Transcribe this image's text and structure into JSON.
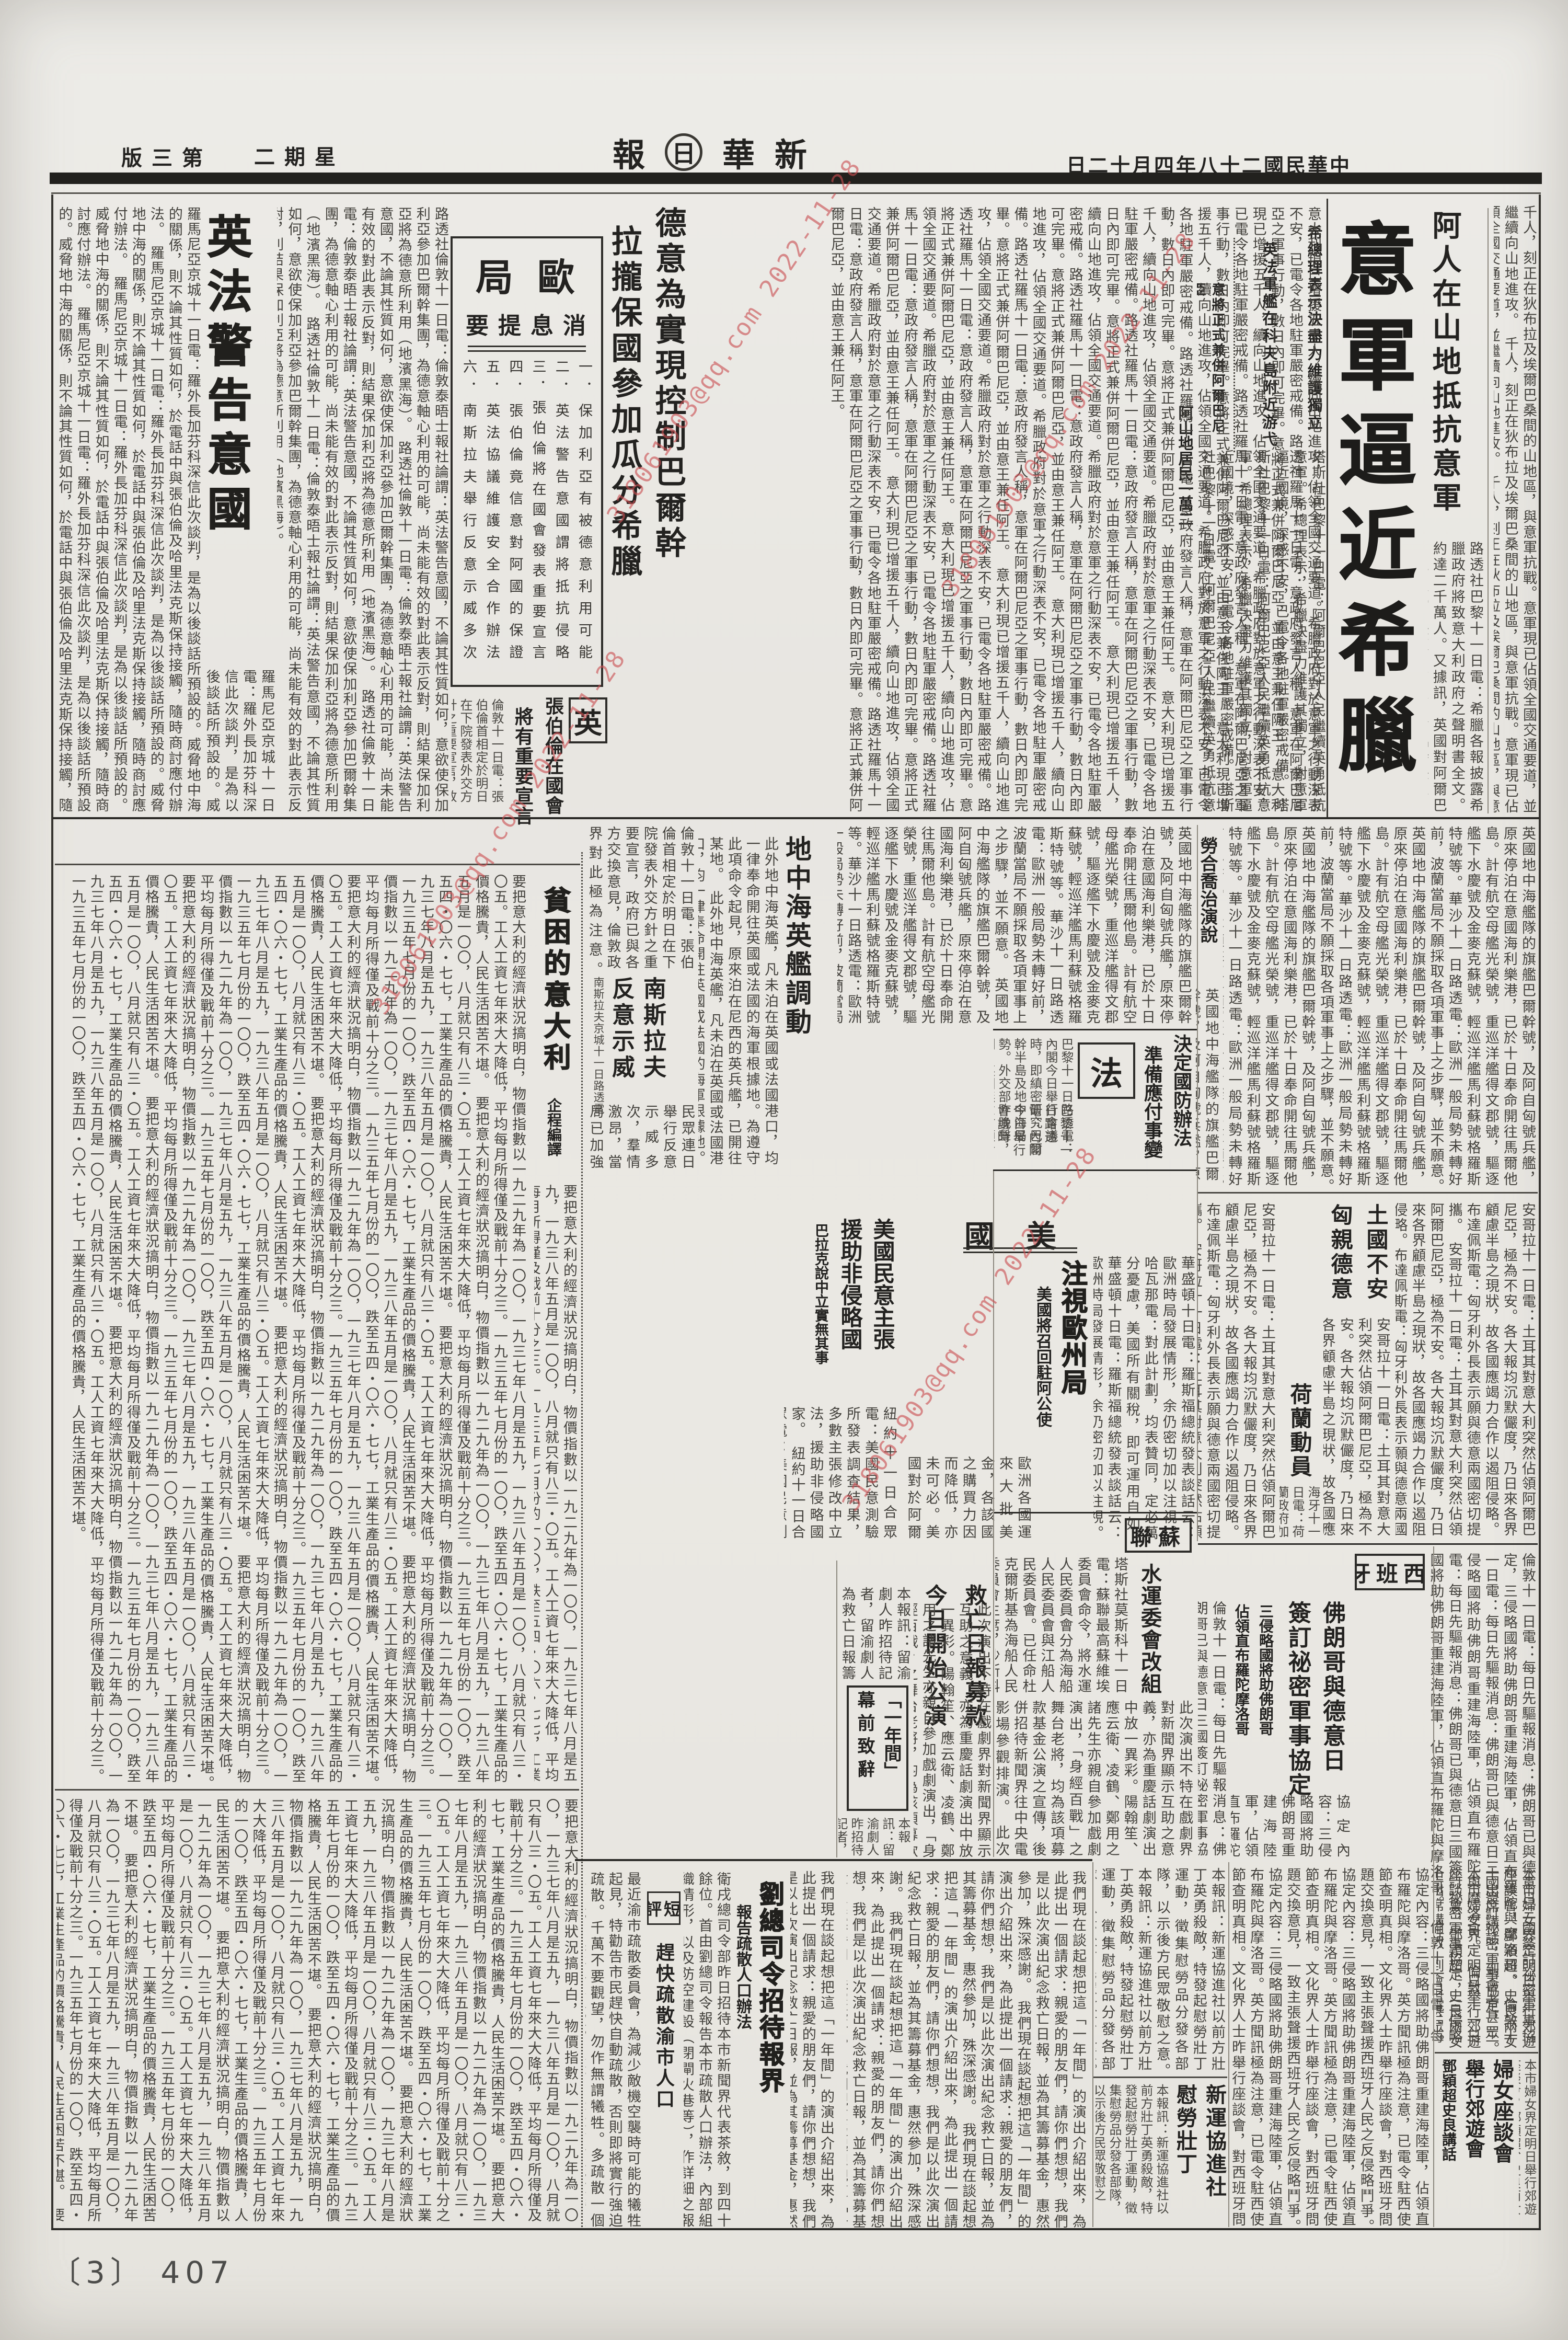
{
  "page": {
    "number_label": "〔3〕 407"
  },
  "watermark": {
    "text": "318061903@qq.com 2022-11-28"
  },
  "header": {
    "date": "中華民國二十八年四月十二日",
    "date_display": "日二十月四年八十二國民華中",
    "masthead": "新華日報",
    "masthead_chars": [
      "報",
      "日",
      "華",
      "新"
    ],
    "weekday": "星期二",
    "weekday_display": "二期星",
    "edition": "第三版",
    "edition_display": "版三第"
  },
  "main_story": {
    "kicker": "阿人在山地抵抗意軍",
    "headline": "意軍逼近希臘",
    "subhead1": "希總理表示決盡力維護獨立",
    "subhead2": "英法軍艦在科夫島附近游弋",
    "subhead3": "意將正式兼併阿爾巴尼亞",
    "inline_subhead": "阿山地居民一萬二",
    "col_right": "千人，刻正在狄布拉及埃爾巴桑間的山地區，與意軍抗戰。意軍現已佔領全國交通要道，並繼續向山地進攻。",
    "lead": "塔斯社巴黎十一日電：阿爾巴尼亞人民繼續英勇抵抗意軍。希總理表示，希臘決盡力維護其獨立，對意軍逼近國境，深感不安，已電令各地駐軍嚴密戒備。",
    "body": "路透社巴黎十一日電：希臘各報披露希臘政府將致意大利政府之聲明書全文。約達二千萬人。又據訊，英國對阿爾巴尼亞問題的決策，有賴國會臨時決定的可能。又各方對於科夫島的風雲，意大利仍密切注意，英國當不致採取較強硬之外交動作。（中央社）"
  },
  "europe_digest": {
    "title": "歐局",
    "title_display": "局歐",
    "subtitle": "消息提要",
    "subtitle_display": "要提息消",
    "items": [
      "一．保加利亞有被德意利用可能",
      "二．英法警告意國謂將抵抗侵略",
      "三．張伯倫將在國會發表重要宣言",
      "四．張伯倫竟信意對阿國的保證",
      "五．英法協議維護安全合作辦法",
      "六．南斯拉夫舉行反意示威多次"
    ]
  },
  "germany_italy": {
    "headline_l1": "德意為實現控制巴爾幹",
    "headline_l2": "拉攏保國參加瓜分希臘"
  },
  "uk_section": {
    "label": "英",
    "headline_l1": "張伯倫在國會",
    "headline_l2": "將有重要宣言",
    "body": "倫敦十一日電：張伯倫首相定於明日在下院發表外交方針之重要宣言，政府已與各方交換意見，倫敦政界對此極為注意。"
  },
  "warning_story": {
    "headline": "英法警告意國",
    "body1": "路透社倫敦十一日電：倫敦泰晤士報社論謂：英法警告意國，不論其性質如何，意欲使保加利亞參加巴爾幹集團，為德意軸心利用的可能，尚未能有效的對此表示反對，則結果保加利亞將為德意所利用（地濱黑海）。",
    "body2": "羅馬尼亞京城十一日電：羅外長加芬科深信此次談判，是為以後談話所預設的。威脅地中海的關係，則不論其性質如何，於電話中與張伯倫及哈里法克斯保持接觸，隨時商討應付辦法。"
  },
  "mediterranean": {
    "headline": "地中海英艦調動",
    "body": "此外地中海英艦，凡未泊在英國或法國港口，均一律奉命開往英國或法國的海軍根據地。為遵守此項命令起見，原來泊在尼西的英兵艦，已開往某地。"
  },
  "lloyd_george": {
    "headline": "勞合喬治演說"
  },
  "yugoslavia": {
    "headline_l1": "南斯拉夫",
    "headline_l2": "反意示威",
    "dateline": "南斯拉夫京城十一日路透電",
    "body": "民眾連日舉行反意示威多次，羣情激昂，當局已加強戒備，並成立物物交換協定。"
  },
  "poor_italy": {
    "headline": "貧困的意大利",
    "credit": "企程編譯",
    "body": "要把意大利的經濟狀況搞明白，物價指數以一九二九年為一〇〇，一九三七年八月是五九，一九三八年五月是一〇〇，八月就只有八三・〇五。工人工資七年來大大降低，平均每月所得僅及戰前十分之三。一九三五年七月份的一〇〇，跌至五四・〇六・七七，工業生產品的價格騰貴，人民生活困苦不堪。"
  },
  "france_section": {
    "label": "法",
    "headline_l1": "決定國防辦法",
    "headline_l2": "準備應付事變",
    "body": "巴黎十一日路透電：內閣今日舉行會議時，即縝密研究巴爾幹半島及地中海局勢。外交部昨晚聲明，英國無意佔領希臘的科夫島。但英法當就維護安全的合作辦法，舉行協議。"
  },
  "us_section": {
    "label": "美國",
    "label_display": "國美",
    "headline": "注視歐州局勢",
    "subhead": "美國將召回駐阿公使",
    "body": "華盛頓十日電：羅斯福總統發表談話云：歐洲時局發展情形，余仍密切加以注視。哈瓦那電：對此計劃，均表贊同，定必萬分憂慮，美國所有關稅，即可運用自如。"
  },
  "us_opinion": {
    "headline_l1": "美國民意主張",
    "headline_l2": "援助非侵略國",
    "subhead": "巴拉克說中立實無其事",
    "body": "紐約十一日合眾電：美國民意測驗所發表調查結果，多數主張修改中立法，援助非侵略國家。"
  },
  "turkey": {
    "headline": "土國不安"
  },
  "hungary": {
    "headline": "匈親德意"
  },
  "holland": {
    "headline": "荷蘭動員",
    "body": "海牙十一日電：荷蘭政府加強戒備，已下令動員若干部隊，並嚴密注視國際形勢之演變。"
  },
  "ussr_section": {
    "label": "蘇聯",
    "label_display": "聯蘇",
    "headline": "水運委會改組",
    "body": "塔斯社莫斯科十一日電：蘇聯最高蘇維埃委員會命令，將水運人民委員會分為海船人民委員會與江船人民委員會。已任命杜克爾斯基為海船人民委員會主席，沙斯科夫為江船人民委員會主席。"
  },
  "spain_section": {
    "label": "西班牙",
    "label_display": "牙班西",
    "headline_l1": "佛朗哥與德意日",
    "headline_l2": "簽訂祕密軍事協定",
    "subhead_l1": "三侵略國將助佛朗哥",
    "subhead_l2": "佔領直布羅陀摩洛哥",
    "body": "倫敦十一日電：每日先驅報消息：佛朗哥已與德意日三國簽訂祕密軍事協定，三侵略國將助佛朗哥重建海陸軍，佔領直布羅陀與摩洛哥。"
  },
  "jiuwang": {
    "headline_l1": "救亡日報募款",
    "headline_l2": "今日開始公演",
    "body": "本報訊：留渝劇人昨招待記者，留渝劇人為救亡日報籌募基金演出之四幕劇「一年間」，今日開始公演。"
  },
  "one_year": {
    "headline_l1": "「一年間」",
    "headline_l2": "幕前致辭",
    "body": "此次演出不特在戲劇界對新聞界顯示互助之意義，亦為重慶話劇演出中放一異彩。陽翰笙、應云衛、凌鶴、鄭用之諸先生亦親自參加戲劇演出，「身經百戰」之舞台老將，均為該項募款基金公演之宣傳，後併招待新聞界往中央電影場參觀排演。"
  },
  "liu_commander": {
    "headline": "劉總司令招待報界",
    "subhead": "報告疏散人口辦法",
    "body": "衛戌總司令部昨日招待本市新聞界代表茶敘，到四十餘位。首由劉總司令報告本市疏散人口辦法，內部組織情形，以及防空建設（閉閘火巷等），作詳細之報告後，新聞界代表等亦相繼發言，對於疏散工作之推進交換意見。"
  },
  "short_comment": {
    "label": "短評",
    "label_display": "評短",
    "headline": "趕快疏散渝市人口",
    "body": "最近渝市疏散委員會，為減少敵機空襲時可能的犧牲起見，特勸告市民趕快自動疏散，否則即將實行強迫疏散。千萬不要觀望，勿作無謂犧牲。多疏散一個人，就多保存一分抗戰力量。"
  },
  "xinyun": {
    "headline_l1": "新運協進社",
    "headline_l2": "慰勞壯丁",
    "body": "本報訊：新運協進社以前方壯丁英勇殺敵，特發起慰勞壯丁運動，徵集慰勞品分發各部隊，以示後方民眾敬慰之意。"
  },
  "women": {
    "headline_l1": "婦女座談會",
    "headline_l2": "舉行郊遊會",
    "subhead": "鄧穎超史良講話",
    "body": "本市婦女界定明日舉行郊遊座談會，鄧穎超、史良兩女士出席講話，到會者甚眾。"
  },
  "fillers": {
    "main_cont": "意大利現已增援五千人，續向山地進攻，佔領全國交通要道。希臘政府對於意軍之行動深表不安，已電令各地駐軍嚴密戒備。路透社羅馬十一日電：意政府發言人稱，意軍在阿爾巴尼亞之軍事行動，數日內即可完畢。意將正式兼併阿爾巴尼亞，並由意王兼任阿王。",
    "band2_right": "英國地中海艦隊的旗艦巴爾幹號，及阿自匈號兵艦，原來停泊在意國海利樂港，已於十日奉命開往馬爾他島。計有航空母艦光榮號，重巡洋艦得文郡號，驅逐艦下水慶號及金麥克蘇號，輕巡洋艦馬利蘇號格羅斯特號等。華沙十一日路透電：歐洲一般局勢未轉好前，波蘭當局不願採取各項軍事上之步驟，並不願意。",
    "us_misc": "歐洲各國運來大批美金，各該國之購買力因而降低，亦未可必。美國對於阿爾巴尼亞一事，將靜觀其後略。對此計劃，均表贊同，即可運用自如。（中央社）",
    "turkey_hungary": "安哥拉十一日電：土耳其對意大利突然佔領阿爾巴尼亞，極為不安。各大報均沉默儼度，乃日來各界顧慮半島之現狀，故各國應竭力合作以遏阻侵略。布達佩斯電：匈牙利外長表示願與德意兩國密切提攜。",
    "spain_cont": "協定內容：三侵略國將助佛朗哥重建海陸軍，佔領直布羅陀與摩洛哥。英方聞訊極為注意，已電令駐西使節查明真相。文化界人士昨舉行座談會，對西班牙問題交換意見，一致主張聲援西班牙人民之反侵略鬥爭。",
    "one_year_essay": "我們現在談起想把這「一年間」的演出介紹出來，為此提出一個請求：親愛的朋友們，請你們想想，我們是以此次演出紀念救亡日報，並為其籌募基金，惠然參加，殊深感謝。"
  }
}
